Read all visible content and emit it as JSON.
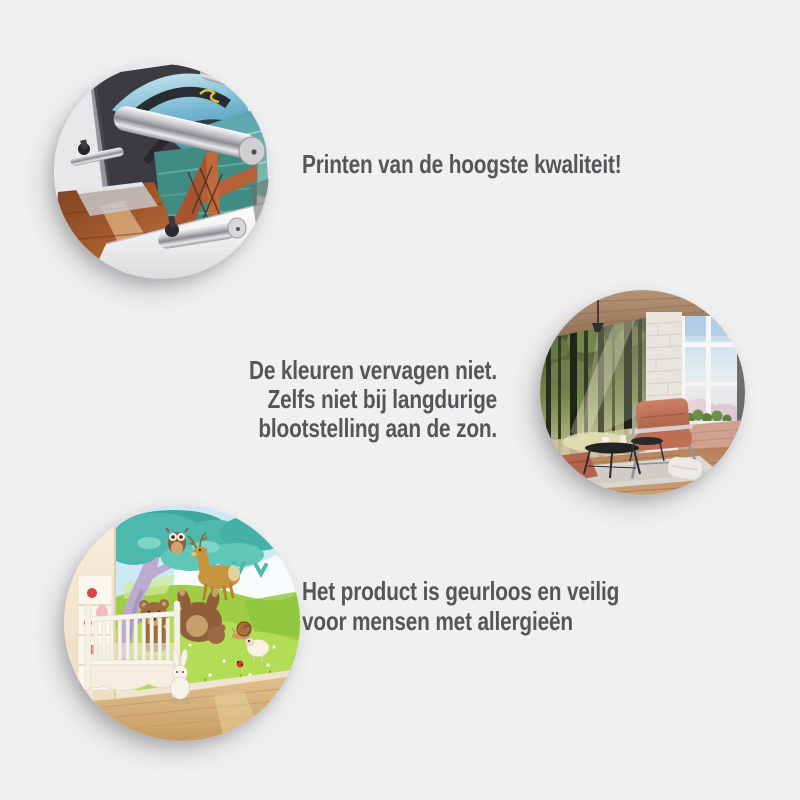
{
  "page": {
    "background_color": "#f0f0f1",
    "text_color": "#56565a"
  },
  "benefits": [
    {
      "id": "print-quality",
      "image_name": "printer-closeup-photo",
      "image_description": "Close-up of a large-format printer with metal rollers printing a mural of a wooden bridge over water",
      "lines": [
        "Printen van de hoogste kwaliteit!"
      ]
    },
    {
      "id": "no-fading",
      "image_name": "interior-forest-mural-photo",
      "image_description": "Loft living room with sunlit forest photo wallpaper, leather armchair, coffee tables and large windows",
      "lines": [
        "De kleuren vervagen niet.",
        "Zelfs niet bij langdurige",
        "blootstelling aan de zon."
      ]
    },
    {
      "id": "odorless-safe",
      "image_name": "nursery-animal-mural-photo",
      "image_description": "Children's room with cartoon forest-animals wallpaper (tree, owl, deer, bears) behind a white crib",
      "lines": [
        "Het product is geurloos en veilig",
        "voor mensen met allergieën"
      ]
    }
  ]
}
